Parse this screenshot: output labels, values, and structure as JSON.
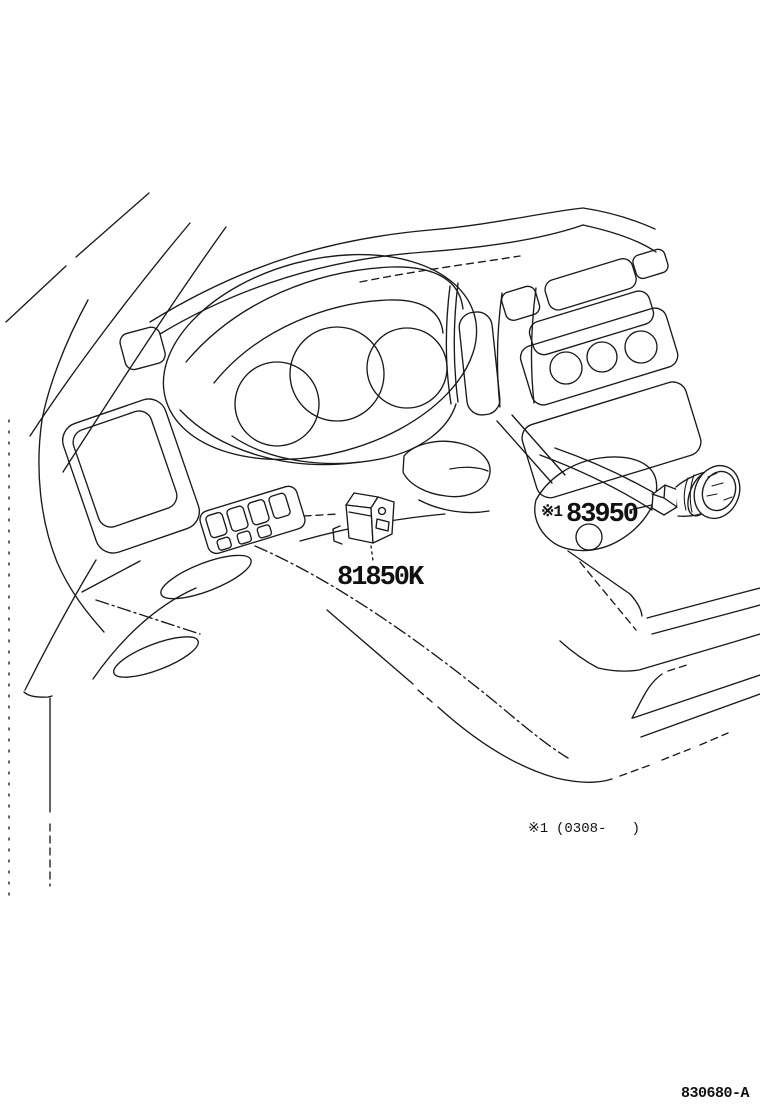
{
  "colors": {
    "ink": "#1a1a1a",
    "background": "#ffffff"
  },
  "callouts": {
    "part_83950": {
      "marker": "※1",
      "number": "83950"
    },
    "part_81850k": {
      "number": "81850K"
    }
  },
  "footnote": {
    "marker": "※1",
    "range": "(0308-   )"
  },
  "figure_code": "830680-A"
}
